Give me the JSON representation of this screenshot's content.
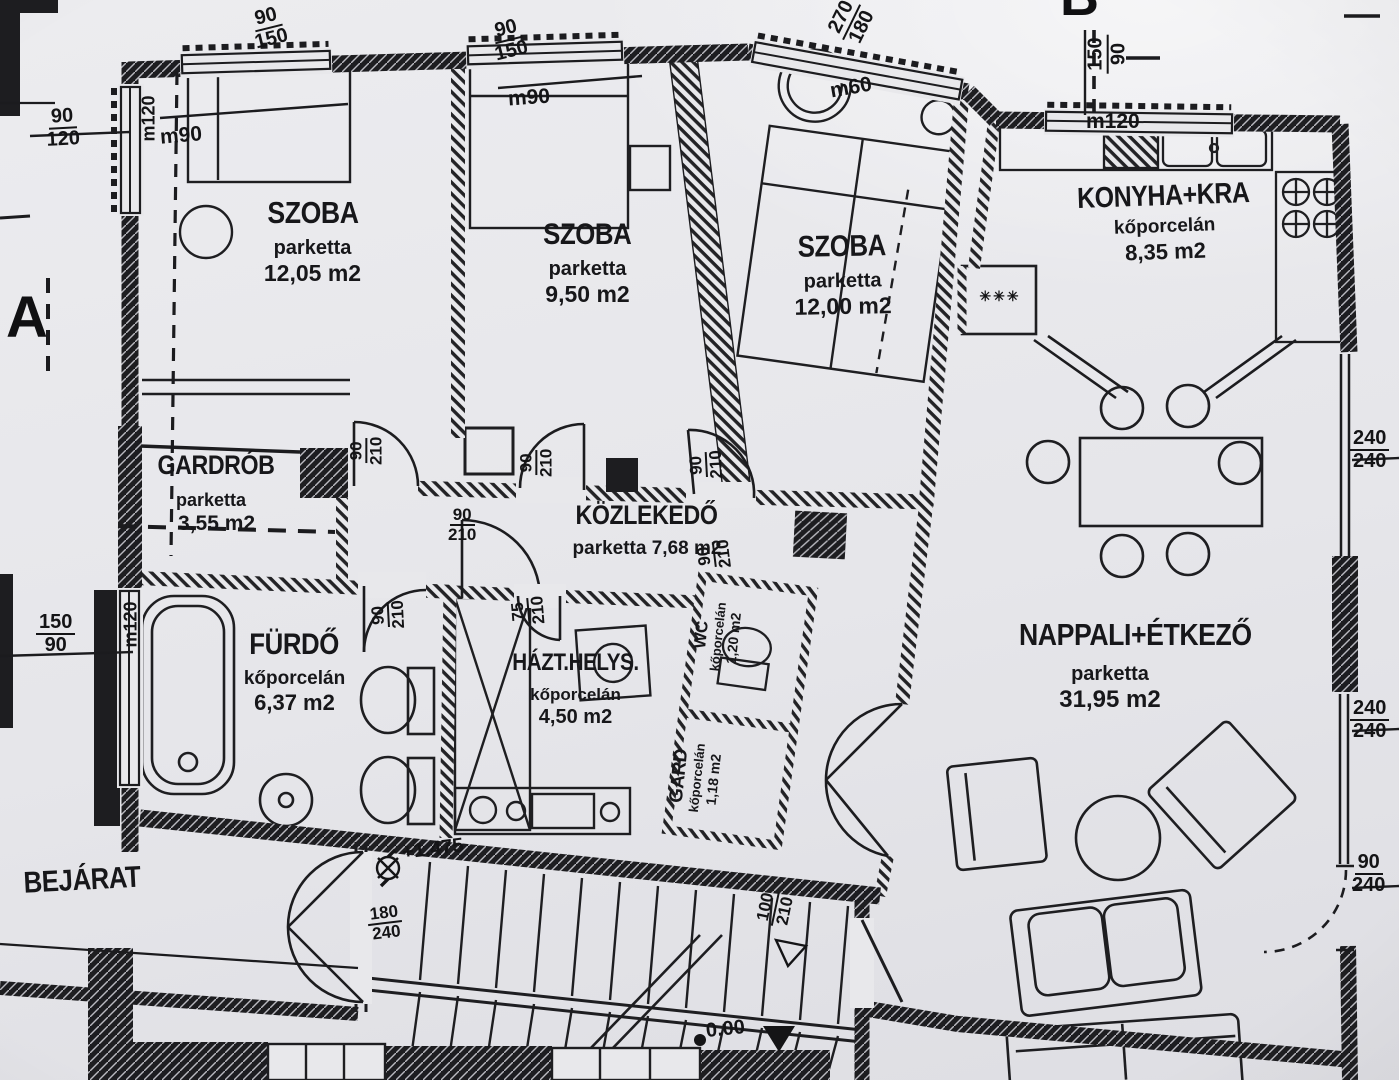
{
  "rooms": [
    {
      "name": "SZOBA",
      "material": "parketta",
      "area": "12,05 m2"
    },
    {
      "name": "SZOBA",
      "material": "parketta",
      "area": "9,50 m2"
    },
    {
      "name": "SZOBA",
      "material": "parketta",
      "area": "12,00 m2"
    },
    {
      "name": "KONYHA+KRA",
      "material": "kőporcelán",
      "area": "8,35 m2"
    },
    {
      "name": "GARDRÓB",
      "material": "parketta",
      "area": "3,55 m2"
    },
    {
      "name": "KÖZLEKEDŐ",
      "material": "parketta",
      "area": "7,68 m2"
    },
    {
      "name": "FÜRDŐ",
      "material": "kőporcelán",
      "area": "6,37 m2"
    },
    {
      "name": "HÁZT.HELYS.",
      "material": "kőporcelán",
      "area": "4,50 m2"
    },
    {
      "name": "WC",
      "material": "kőporcelán",
      "area": "1,20 m2"
    },
    {
      "name": "GARD",
      "material": "kőporcelán",
      "area": "1,18 m2"
    },
    {
      "name": "NAPPALI+ÉTKEZŐ",
      "material": "parketta",
      "area": "31,95 m2"
    },
    {
      "name": "BEJÁRAT"
    }
  ],
  "dims": {
    "win1": {
      "t": "90",
      "b": "150"
    },
    "win1_sill": "m90",
    "win2": {
      "t": "90",
      "b": "150"
    },
    "win2_sill": "m90",
    "win3": {
      "t": "270",
      "b": "180"
    },
    "win3_sill": "m60",
    "win4": {
      "t": "150",
      "b": "90"
    },
    "win4_sill": "m120",
    "win5": {
      "t": "90",
      "b": "120"
    },
    "win5_sill": "m120",
    "win6": {
      "t": "150",
      "b": "90"
    },
    "win6_sill": "m120",
    "open1": {
      "t": "240",
      "b": "240"
    },
    "open2": {
      "t": "240",
      "b": "240"
    },
    "door_terrace": {
      "t": "90",
      "b": "240"
    },
    "door_szoba1": {
      "t": "90",
      "b": "210"
    },
    "door_szoba2": {
      "t": "90",
      "b": "210"
    },
    "door_szoba3": {
      "t": "90",
      "b": "210"
    },
    "door_kozlekedo": {
      "t": "90",
      "b": "210"
    },
    "door_furdo": {
      "t": "90",
      "b": "210"
    },
    "door_hazt": {
      "t": "75",
      "b": "210"
    },
    "door_wc": {
      "t": "90",
      "b": "210"
    },
    "door_stair": {
      "t": "100",
      "b": "210"
    },
    "door_entry": {
      "t": "180",
      "b": "240"
    }
  },
  "levels": {
    "upper": "+1.475",
    "ground": "0.00"
  },
  "sections": {
    "a": "A",
    "b": "B"
  },
  "symbols": {
    "pantry": "✳✳✳"
  }
}
